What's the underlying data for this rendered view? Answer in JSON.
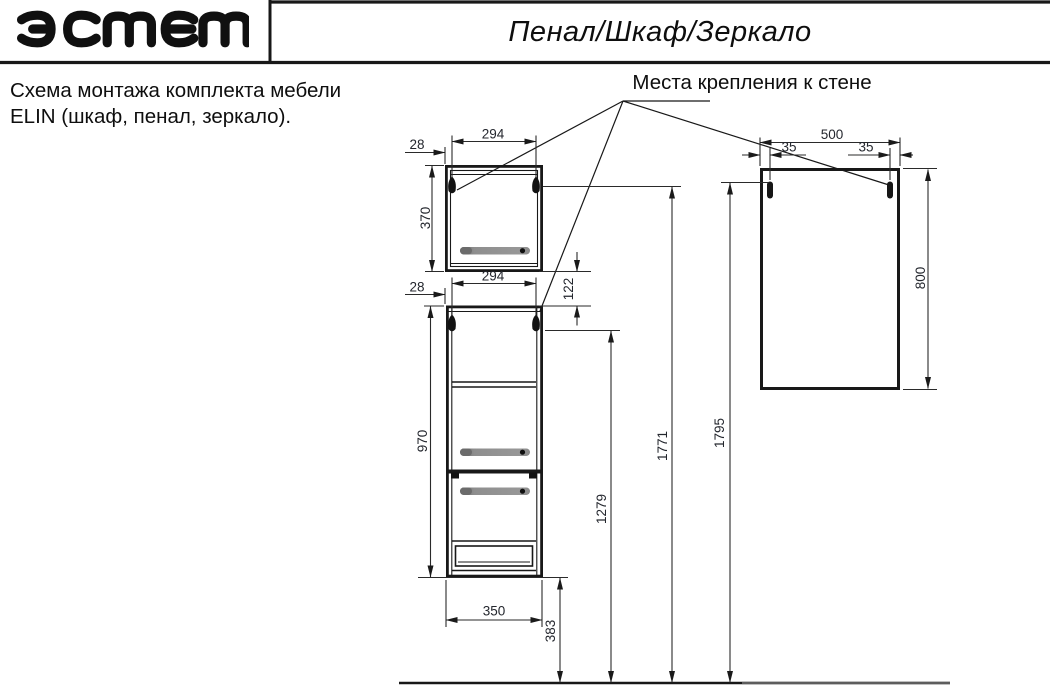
{
  "header": {
    "brand_logo_name": "estet-logo",
    "brand_logo_text": "эстет",
    "title": "Пенал/Шкаф/Зеркало"
  },
  "description": {
    "line1": "Схема монтажа комплекта мебели",
    "line2": "ELIN (шкаф, пенал, зеркало)."
  },
  "annotation": {
    "mount_label": "Места крепления к стене"
  },
  "dims": {
    "top_cabinet": {
      "mount_span": "294",
      "edge_offset": "28",
      "height": "370",
      "mount_height_from_floor": "1771"
    },
    "tall_cabinet": {
      "mount_span": "294",
      "edge_offset": "28",
      "gap_below_top_cabinet": "122",
      "height": "970",
      "width": "350",
      "bottom_height_from_floor": "383",
      "mount_height_from_floor": "1279"
    },
    "mirror": {
      "width": "500",
      "mount_offset_left": "35",
      "mount_offset_right": "35",
      "height": "800",
      "mount_height_from_floor": "1795"
    }
  },
  "colors": {
    "line": "#181818",
    "dim_text": "#24272e",
    "handle_gray": "#8f8f8f"
  }
}
